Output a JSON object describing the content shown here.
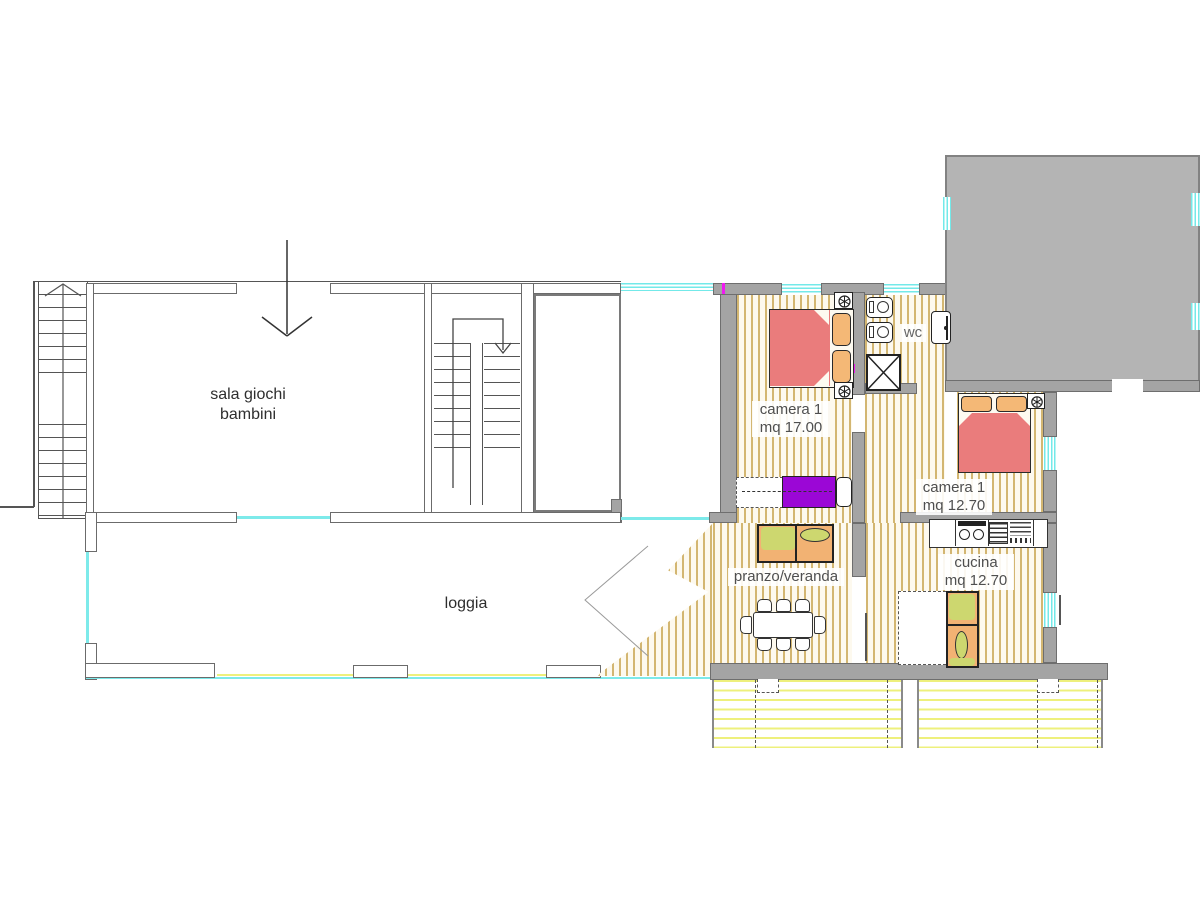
{
  "rooms": {
    "sala_giochi": {
      "line1": "sala giochi",
      "line2": "bambini"
    },
    "loggia": {
      "line1": "loggia"
    },
    "camera1": {
      "line1": "camera 1",
      "line2": "mq 17.00"
    },
    "wc": {
      "line1": "wc"
    },
    "camera2": {
      "line1": "camera 1",
      "line2": "mq 12.70"
    },
    "pranzo": {
      "line1": "pranzo/veranda"
    },
    "cucina": {
      "line1": "cucina",
      "line2": "mq 12.70"
    }
  },
  "colors": {
    "wall_fill": "#a4a4a4",
    "wall_outline": "#6e6e6e",
    "block_fill": "#b4b4b4",
    "floor_stripe": "#d3b671",
    "window_cyan": "#73e9e9",
    "balcony_stripe": "#eef07c",
    "bed_red": "#ea7c7c",
    "pillow_orange": "#f4b876",
    "bed_purple": "#9b07d6",
    "cushion_green": "#cdd76f",
    "accent_magenta": "#ff00ff"
  }
}
